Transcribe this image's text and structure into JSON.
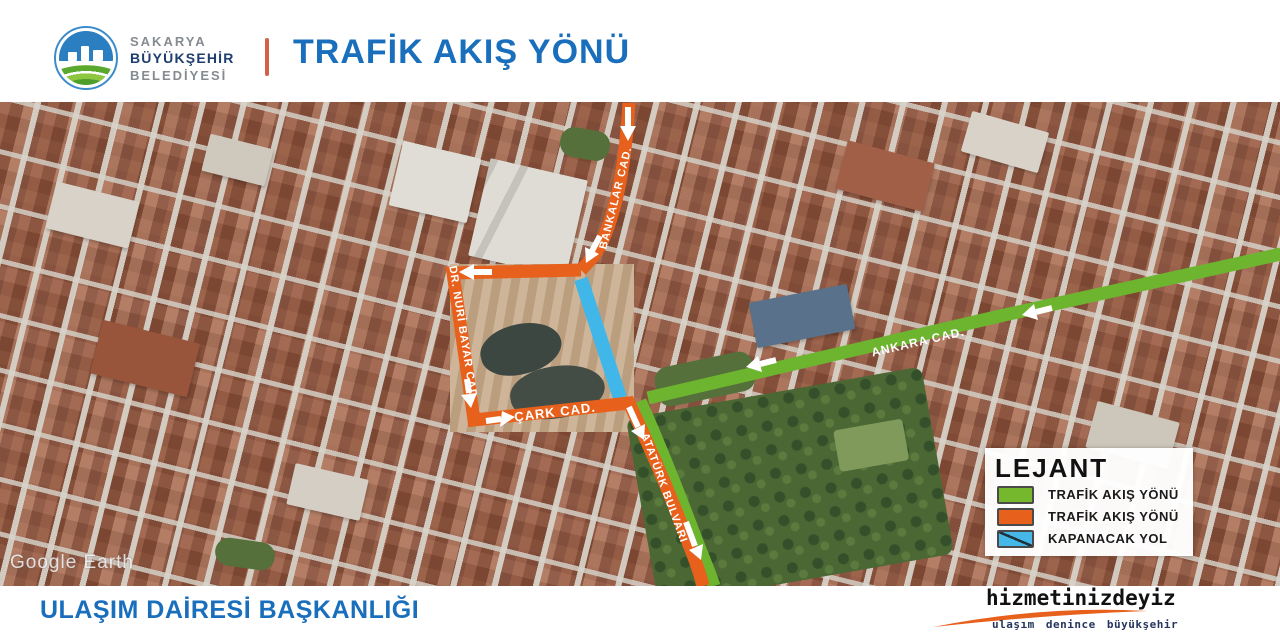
{
  "header": {
    "municipality": {
      "line1": "SAKARYA",
      "line2": "BÜYÜKŞEHİR",
      "line3": "BELEDİYESİ"
    },
    "title": "TRAFİK AKIŞ YÖNÜ",
    "accent_colors": {
      "title_blue": "#1a6fbd",
      "divider_orange": "#d4604a"
    }
  },
  "map": {
    "watermark": "Google Earth",
    "street_labels": [
      {
        "id": "bankalar",
        "text": "BANKALAR CAD."
      },
      {
        "id": "dr_nuri_bayar",
        "text": "DR. NURİ BAYAR CAD."
      },
      {
        "id": "cark",
        "text": "ÇARK CAD."
      },
      {
        "id": "ataturk",
        "text": "ATATÜRK BULVARI"
      },
      {
        "id": "ankara",
        "text": "ANKARA CAD."
      }
    ],
    "legend": {
      "title": "LEJANT",
      "items": [
        {
          "label": "TRAFİK AKIŞ YÖNÜ",
          "color": "#76b82d"
        },
        {
          "label": "TRAFİK AKIŞ YÖNÜ",
          "color": "#e8611c"
        },
        {
          "label": "KAPANACAK YOL",
          "color": "#45b8e8"
        }
      ]
    },
    "route_colors": {
      "flow_green": "#6eb52f",
      "flow_orange": "#e8611c",
      "closed_road": "#41b7e9"
    }
  },
  "footer": {
    "department": "ULAŞIM DAİRESİ BAŞKANLIĞI",
    "brand": {
      "main": "hizmetinizdeyiz",
      "sub": "ulaşım denince büyükşehir",
      "accent": "#e8611c"
    }
  }
}
